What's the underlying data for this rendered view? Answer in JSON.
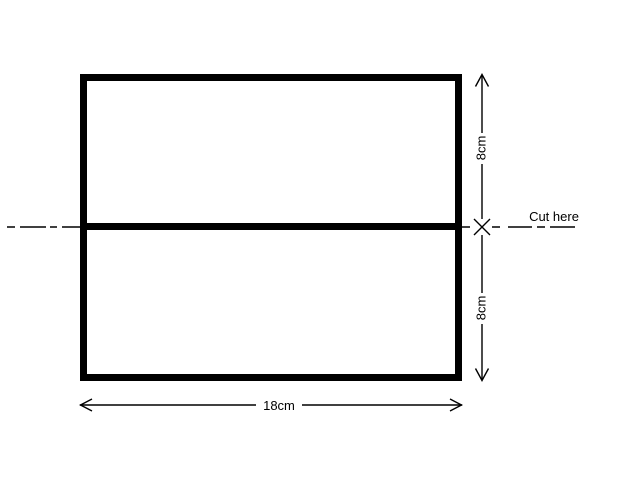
{
  "colors": {
    "line": "#000000",
    "background": "#ffffff"
  },
  "diagram": {
    "labels": {
      "top_height": "8cm",
      "bottom_height": "8cm",
      "total_width": "18cm",
      "cut_here": "Cut here"
    }
  }
}
